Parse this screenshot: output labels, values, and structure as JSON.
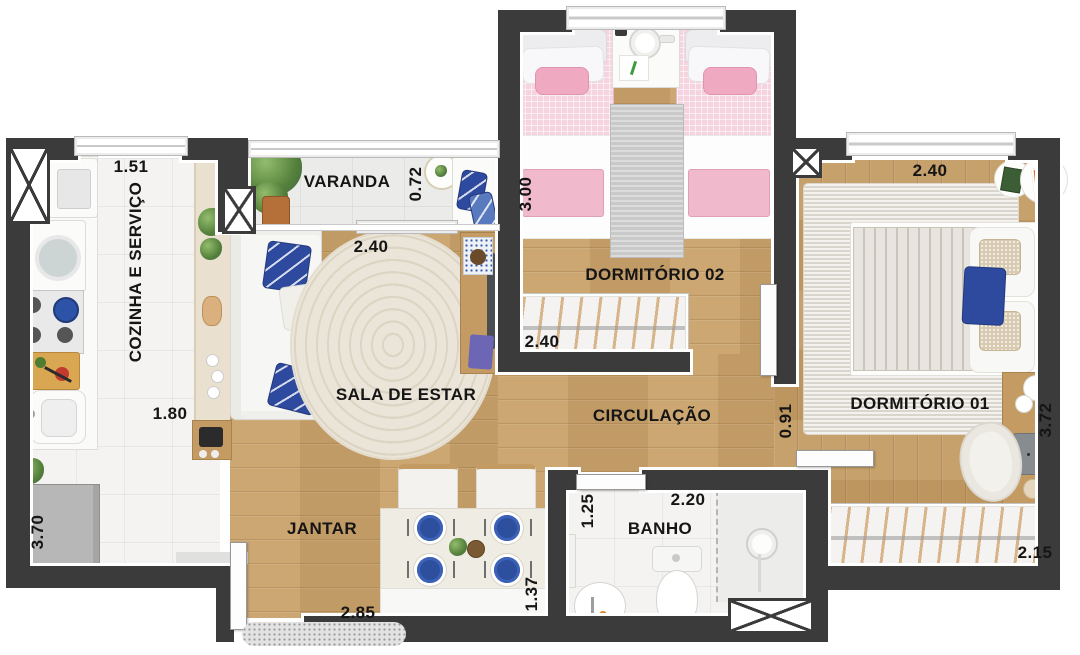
{
  "floorplan": {
    "rooms": {
      "kitchen": {
        "label": "COZINHA E SERVIÇO",
        "dim_width": "1.51",
        "dim_length": "1.80",
        "dim_side": "3.70"
      },
      "balcony": {
        "label": "VARANDA",
        "dim_depth": "0.72"
      },
      "living": {
        "label": "SALA DE ESTAR",
        "dim_width": "2.40"
      },
      "dining": {
        "label": "JANTAR",
        "dim_width": "2.85",
        "dim_depth": "1.37"
      },
      "bedroom2": {
        "label": "DORMITÓRIO 02",
        "dim_depth": "3.00",
        "dim_closet": "2.40"
      },
      "hall": {
        "label": "CIRCULAÇÃO",
        "dim_width": "0.91"
      },
      "bathroom": {
        "label": "BANHO",
        "dim_depth": "1.25",
        "dim_width": "2.20"
      },
      "bedroom1": {
        "label": "DORMITÓRIO 01",
        "dim_width": "2.40",
        "dim_depth": "3.72",
        "dim_closet": "2.15"
      }
    },
    "colors": {
      "wall": "#3b3b3b",
      "wood_floor": "#c9a26b",
      "accent_blue": "#2e4a9e",
      "accent_pink": "#f2c3d2",
      "tile": "#f4f3f2"
    }
  }
}
